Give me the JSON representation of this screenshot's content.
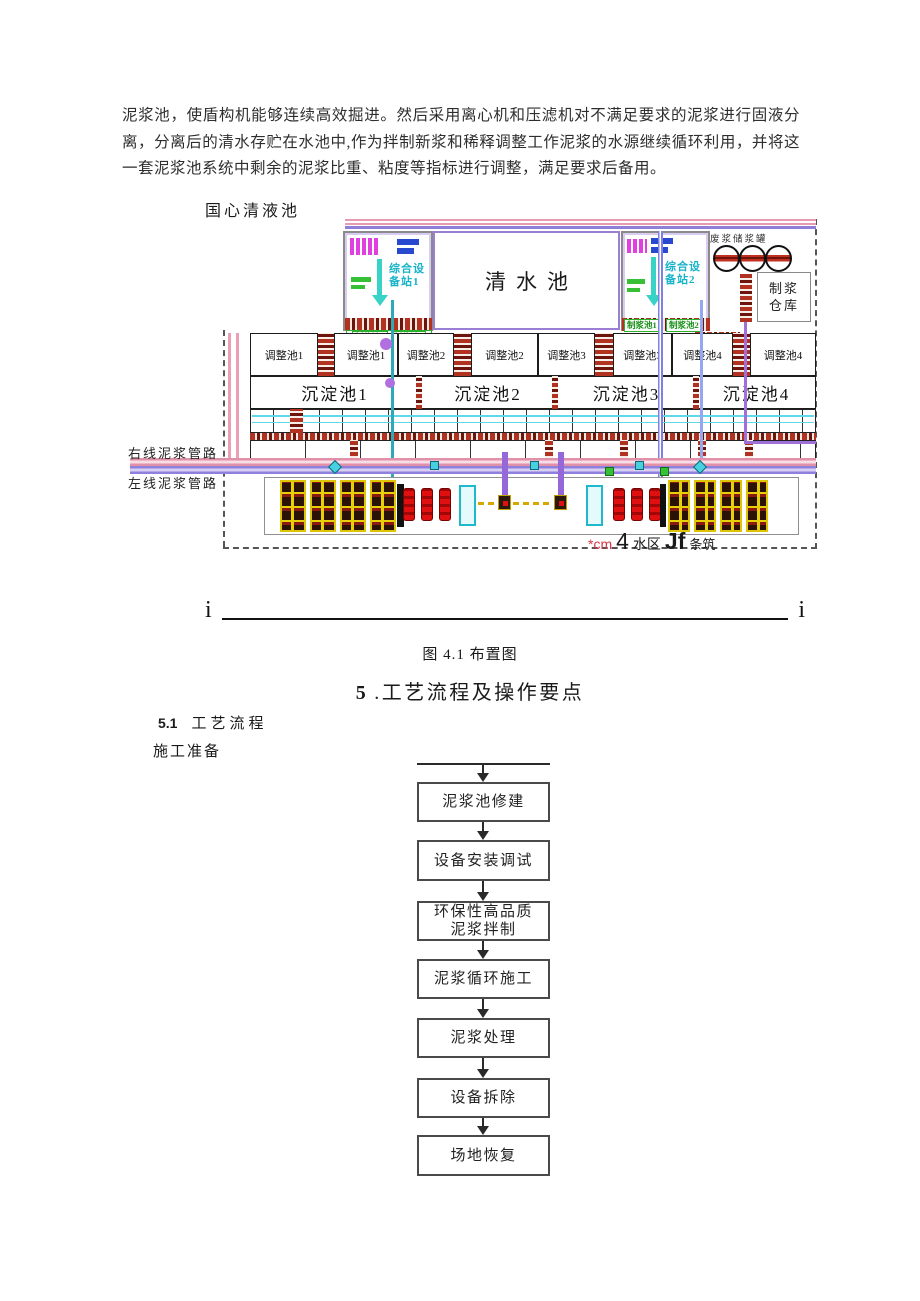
{
  "intro_paragraph": "泥浆池，使盾构机能够连续高效掘进。然后采用离心机和压滤机对不满足要求的泥浆进行固液分离，分离后的清水存贮在水池中,作为拌制新浆和稀释调整工作泥浆的水源继续循环利用，并将这一套泥浆池系统中剩余的泥浆比重、粘度等指标进行调整，满足要求后备用。",
  "diagram": {
    "top_label": "国心清液池",
    "clear_water_pool": "清水池",
    "station1": "综合设备站1",
    "station2": "综合设备站2",
    "tank_label": "废浆储浆罐",
    "warehouse": "制浆仓库",
    "mixing_labels": [
      "制浆池1",
      "制浆池2"
    ],
    "adjust_pools": [
      "调整池1",
      "调整池1",
      "调整池2",
      "调整池2",
      "调整池3",
      "调整池3",
      "调整池4",
      "调整池4"
    ],
    "sediment_pools": [
      "沉淀池1",
      "沉淀池2",
      "沉淀池3",
      "沉淀池4"
    ],
    "pipe_right": "右线泥浆管路",
    "pipe_left": "左线泥浆管路",
    "corner_note": {
      "prefix": "*cm",
      "num": "4",
      "area": "水区",
      "jf": "Jf",
      "suffix": "条筑"
    }
  },
  "separator": {
    "left": "i",
    "right": "i"
  },
  "figure_caption": "图 4.1 布置图",
  "heading": {
    "num": "5",
    "rest": ".工艺流程及操作要点"
  },
  "subsection": {
    "num": "5.1",
    "title": "工艺流程"
  },
  "prep_label": "施工准备",
  "flowchart": {
    "steps": [
      "泥浆池修建",
      "设备安装调试",
      "环保性高品质泥浆拌制",
      "泥浆循环施工",
      "泥浆处理",
      "设备拆除",
      "场地恢复"
    ]
  },
  "colors": {
    "hatch_red": "#b23222",
    "pipe_pink": "#e090a8",
    "pipe_purple": "#8f80dd",
    "teal": "#2fa8b8",
    "machine_yellow": "#e8d008",
    "cylinder_red": "#e01010",
    "label_green": "#1fae1f",
    "equipment_cyan": "#28c0d8",
    "note_red": "#e03040"
  }
}
